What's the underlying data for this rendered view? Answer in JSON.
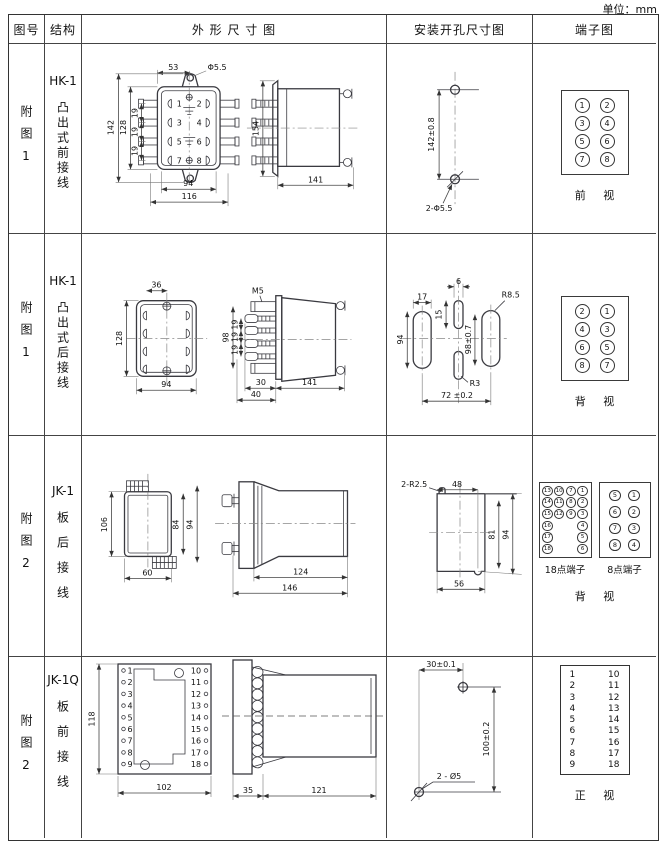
{
  "unit_label": "单位：mm",
  "header": {
    "figure": "图号",
    "structure": "结构",
    "outline": "外 形 尺 寸 图",
    "mounting": "安装开孔尺寸图",
    "terminal": "端子图"
  },
  "rows": [
    {
      "figure": "附图1",
      "model": "HK-1",
      "desc": "凸出式前接线",
      "outline": {
        "d53": "53",
        "dphi": "Φ5.5",
        "d142": "142",
        "d128": "128",
        "d19a": "19",
        "d19b": "19",
        "d19c": "19",
        "d94": "94",
        "d116": "116",
        "d154": "154",
        "d141": "141",
        "terminals": [
          "1",
          "2",
          "3",
          "4",
          "5",
          "6",
          "7",
          "8"
        ]
      },
      "mounting": {
        "dv": "142±0.8",
        "leader": "2-Φ5.5"
      },
      "terminal": {
        "cells": [
          "1",
          "2",
          "3",
          "4",
          "5",
          "6",
          "7",
          "8"
        ],
        "caption": "前 视"
      }
    },
    {
      "figure": "附图1",
      "model": "HK-1",
      "desc": "凸出式后接线",
      "outline": {
        "d36": "36",
        "d128": "128",
        "d94": "94",
        "m5": "M5",
        "d98": "98",
        "d19a": "19",
        "d19b": "19",
        "d19c": "19",
        "d30": "30",
        "d40": "40",
        "d141": "141"
      },
      "mounting": {
        "d17": "17",
        "d6": "6",
        "d15": "15",
        "d94": "94",
        "d98": "98±0.7",
        "r85": "R8.5",
        "r3": "R3",
        "d72": "72 ±0.2"
      },
      "terminal": {
        "cells": [
          "2",
          "1",
          "4",
          "3",
          "6",
          "5",
          "8",
          "7"
        ],
        "caption": "背 视"
      }
    },
    {
      "figure": "附图2",
      "model": "JK-1",
      "desc": "板后接线",
      "outline": {
        "d106": "106",
        "d84": "84",
        "d94": "94",
        "d60": "60",
        "d124": "124",
        "d146": "146"
      },
      "mounting": {
        "leader": "2-R2.5",
        "d48": "48",
        "d81": "81",
        "d94": "94",
        "d56": "56"
      },
      "terminal": {
        "grid18": [
          "13",
          "10",
          "7",
          "1",
          "14",
          "11",
          "8",
          "2",
          "15",
          "12",
          "9",
          "3",
          "16",
          null,
          null,
          "4",
          "17",
          null,
          null,
          "5",
          "18",
          null,
          null,
          "6"
        ],
        "label18": "18点端子",
        "grid8": [
          "5",
          "1",
          "6",
          "2",
          "7",
          "3",
          "8",
          "4"
        ],
        "label8": "8点端子",
        "caption": "背 视"
      }
    },
    {
      "figure": "附图2",
      "model": "JK-1Q",
      "desc": "板前接线",
      "outline": {
        "d118": "118",
        "d102": "102",
        "d35": "35",
        "d121": "121",
        "left_pins": [
          "1",
          "2",
          "3",
          "4",
          "5",
          "6",
          "7",
          "8",
          "9"
        ],
        "right_pins": [
          "10",
          "11",
          "12",
          "13",
          "14",
          "15",
          "16",
          "17",
          "18"
        ]
      },
      "mounting": {
        "d30": "30±0.1",
        "d100": "100±0.2",
        "leader": "2 - Ø5"
      },
      "terminal": {
        "left": [
          "1",
          "2",
          "3",
          "4",
          "5",
          "6",
          "7",
          "8",
          "9"
        ],
        "right": [
          "10",
          "11",
          "12",
          "13",
          "14",
          "15",
          "16",
          "17",
          "18"
        ],
        "caption": "正 视"
      }
    }
  ]
}
